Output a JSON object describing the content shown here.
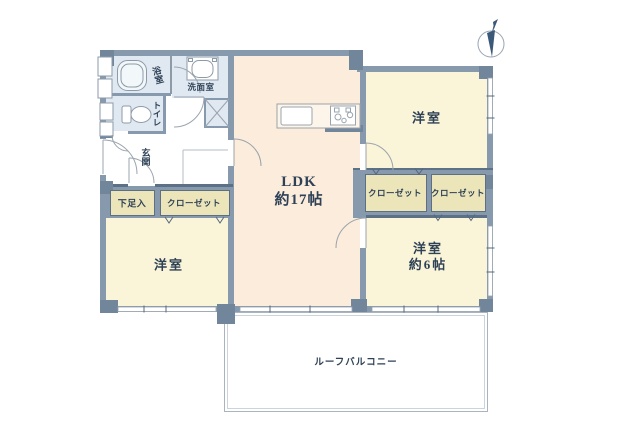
{
  "floorplan": {
    "rooms": {
      "ldk_name": "LDK",
      "ldk_size": "約17帖",
      "bedroom_top_right": "洋室",
      "bedroom_bottom_right_name": "洋室",
      "bedroom_bottom_right_size": "約6帖",
      "bedroom_bottom_left": "洋室",
      "bathroom": "浴室",
      "washroom": "洗面室",
      "toilet": "トイレ",
      "entrance": "玄関",
      "shoe_cupboard": "下足入",
      "closet_bottom_left": "クローゼット",
      "closet_right_a": "クローゼット",
      "closet_right_b": "クローゼット",
      "roof_balcony": "ルーフバルコニー"
    },
    "icons": {
      "compass": "north-compass",
      "bathtub": "bathtub-icon",
      "toilet": "toilet-icon",
      "washing_machine": "washing-machine-icon",
      "kitchen": "kitchen-counter-icon"
    },
    "colors": {
      "wall": "#8799ac",
      "pillar": "#71859b",
      "ldk_fill": "#fcecdb",
      "bedroom_fill": "#faf5d8",
      "closet_fill": "#ece5ba",
      "water_area_fill": "#e0e9f1",
      "label_text": "#2e4156"
    }
  }
}
